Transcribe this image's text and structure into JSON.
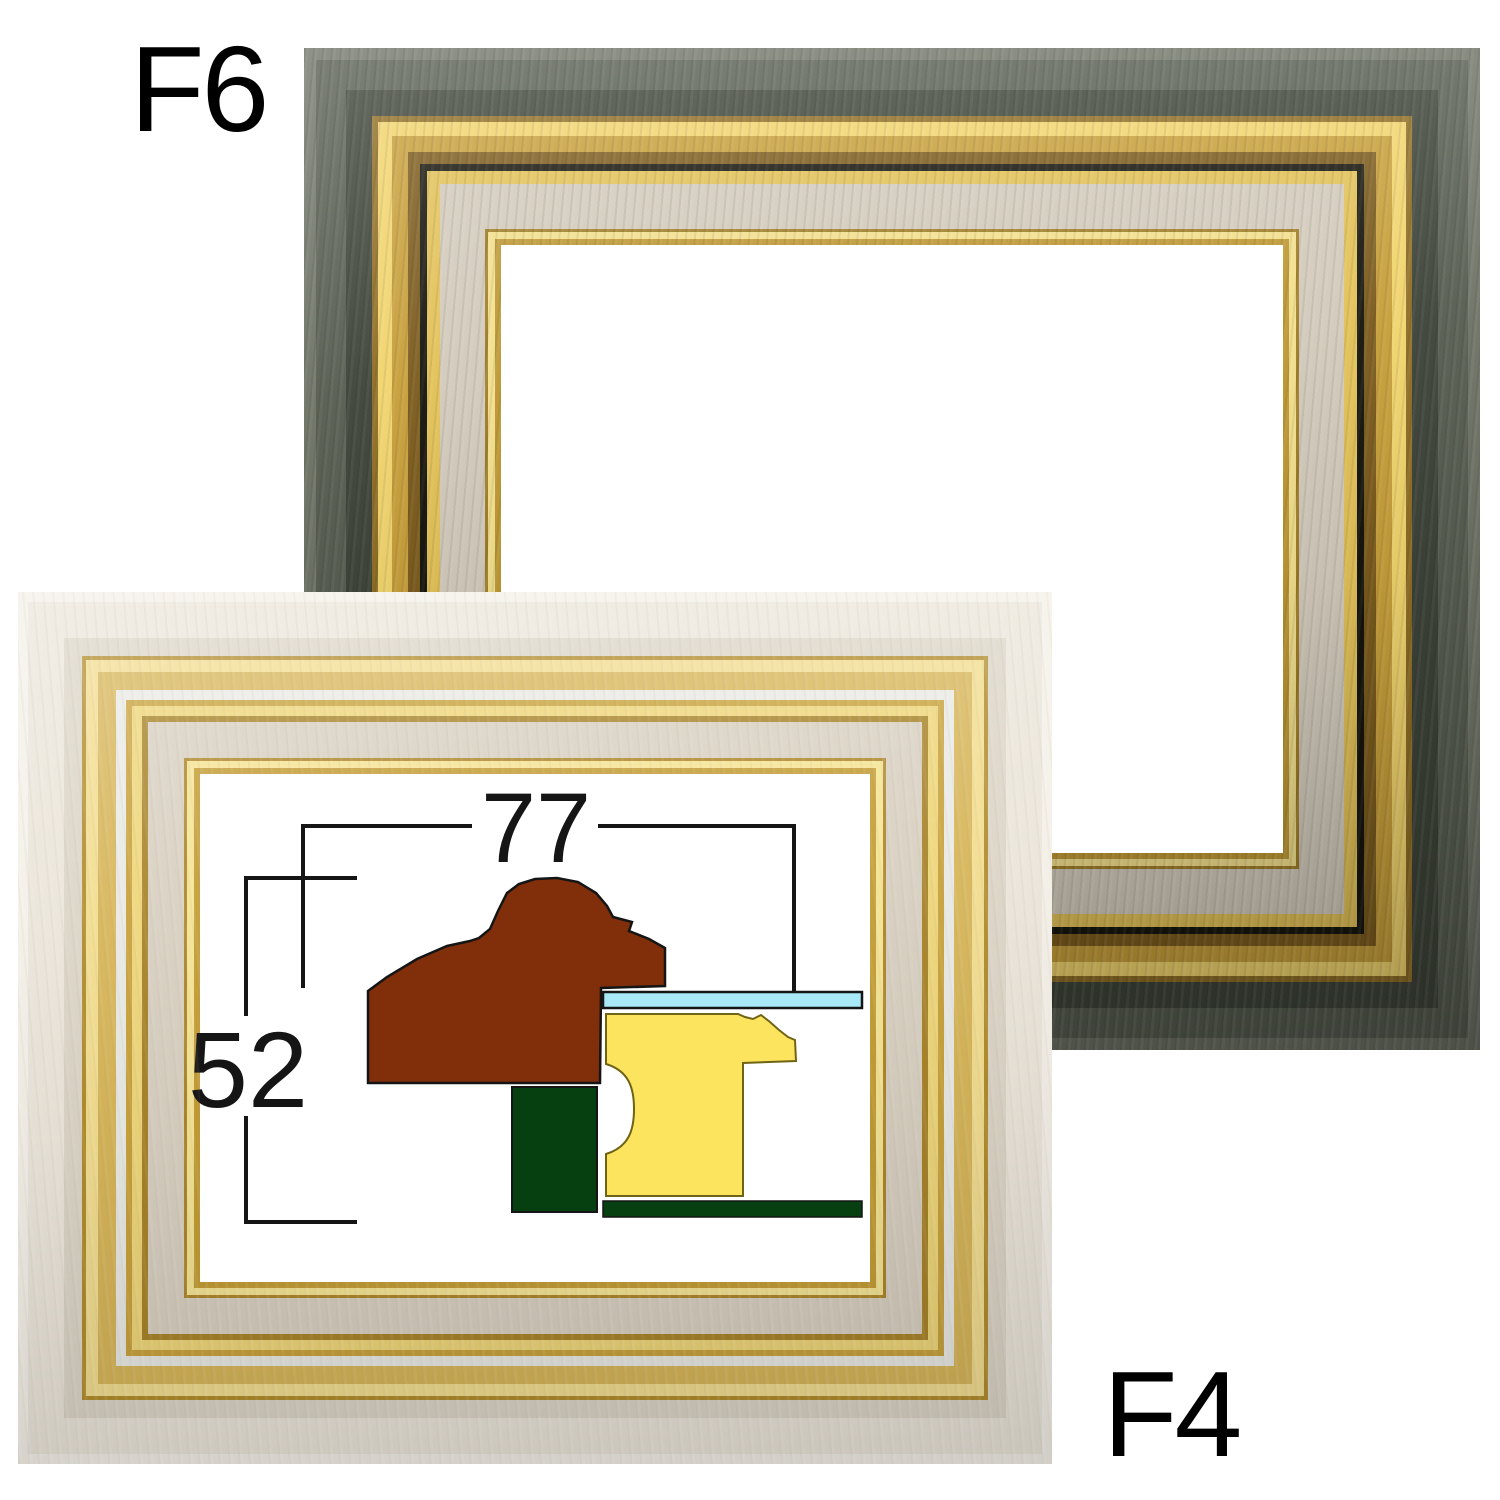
{
  "labels": {
    "top_frame_size": "F6",
    "bottom_frame_size": "F4"
  },
  "diagram": {
    "width_label": "77",
    "height_label": "52",
    "colors": {
      "molding": "#812F0B",
      "glass": "#A9E9F7",
      "liner": "#FCE45F",
      "liner_outline": "#6F6414",
      "backing": "#064010",
      "outline": "#151515"
    }
  },
  "colors": {
    "page-bg": "#FFFFFF",
    "f6-wood-hi": "#6E7366",
    "f6-wood-mid": "#575D51",
    "f6-wood-dark": "#3E4439",
    "f6-gold-edge": "#8F6E25",
    "f6-gold-hi": "#F1D46D",
    "f6-gold-mid": "#C79F3A",
    "f6-gold-shadow": "#7C5C1D",
    "f6-groove": "#16160D",
    "f6-gold-bevel": "#E2C157",
    "f6-linen": "#D2CABB",
    "f6-lip-dark": "#A07E27",
    "f6-lip-hi": "#F2DF8C",
    "f6-lip-mid": "#BD9733",
    "f4-wood-hi": "#F4F0E8",
    "f4-wood-mid": "#EBE5DA",
    "f4-wood-dark": "#DCD5C7",
    "f4-gold-edge": "#B28D2D",
    "f4-gold-hi": "#F2DD90",
    "f4-gold-mid": "#D7B65A",
    "f4-silver": "#E9E9E4",
    "f4-bevel-dark": "#C8A23C",
    "f4-bevel-hi": "#EED67A",
    "f4-bevel-shadow": "#A8842A",
    "f4-linen": "#D8D0C1",
    "f4-lip-dark": "#AD872B",
    "f4-lip-hi": "#F5E494",
    "f4-lip-mid": "#C49D36"
  }
}
